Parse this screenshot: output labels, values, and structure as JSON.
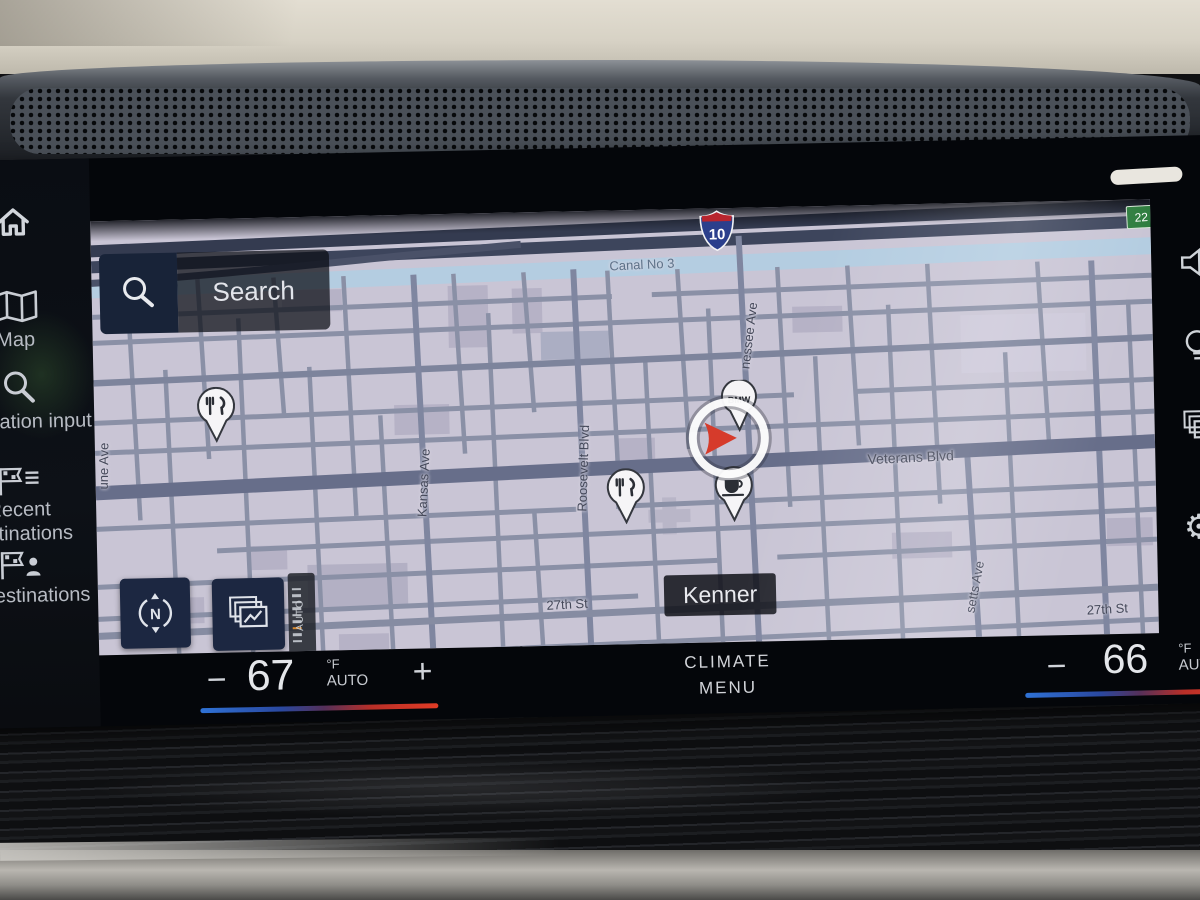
{
  "sidebar": {
    "home_icon": "home-icon",
    "items": [
      {
        "icon": "map-icon",
        "label": "Map"
      },
      {
        "icon": "magnifier-icon",
        "label": "Destination input"
      },
      {
        "icon": "recent-flag-icon",
        "label": "Recent destinations"
      },
      {
        "icon": "my-flag-icon",
        "label": "My destinations"
      }
    ]
  },
  "map": {
    "search_label": "Search",
    "city_label": "Kenner",
    "canal_label": "Canal No 3",
    "interstate_shield": "10",
    "route_badge": "22",
    "auto_zoom_label": "AUTO",
    "bmw_pin_label": "BMW",
    "street_labels": [
      {
        "text": "Veterans Blvd"
      },
      {
        "text": "Kansas Ave"
      },
      {
        "text": "Roosevelt Blvd"
      },
      {
        "text": "nessee Ave"
      },
      {
        "text": "27th St"
      },
      {
        "text": "27th St"
      },
      {
        "text": "setts Ave"
      },
      {
        "text": "une Ave"
      },
      {
        "text": "Ave"
      },
      {
        "text": "ve"
      }
    ]
  },
  "climate": {
    "left": {
      "minus": "−",
      "temp": "67",
      "unit": "°F",
      "mode": "AUTO",
      "plus": "+"
    },
    "center": {
      "line1": "CLIMATE",
      "line2": "MENU"
    },
    "right": {
      "minus": "−",
      "temp": "66",
      "unit": "°F",
      "mode": "AUTO"
    }
  },
  "colors": {
    "map_bg": "#c9c5d5",
    "button_bg": "#1c2741",
    "accent_red": "#d63b2b",
    "badge_green": "#2e7d3f",
    "interstate_blue": "#2b3f8c",
    "interstate_red": "#b8252e",
    "temp_gradient_blue": "#2f72d6",
    "temp_gradient_red": "#e23c25"
  }
}
